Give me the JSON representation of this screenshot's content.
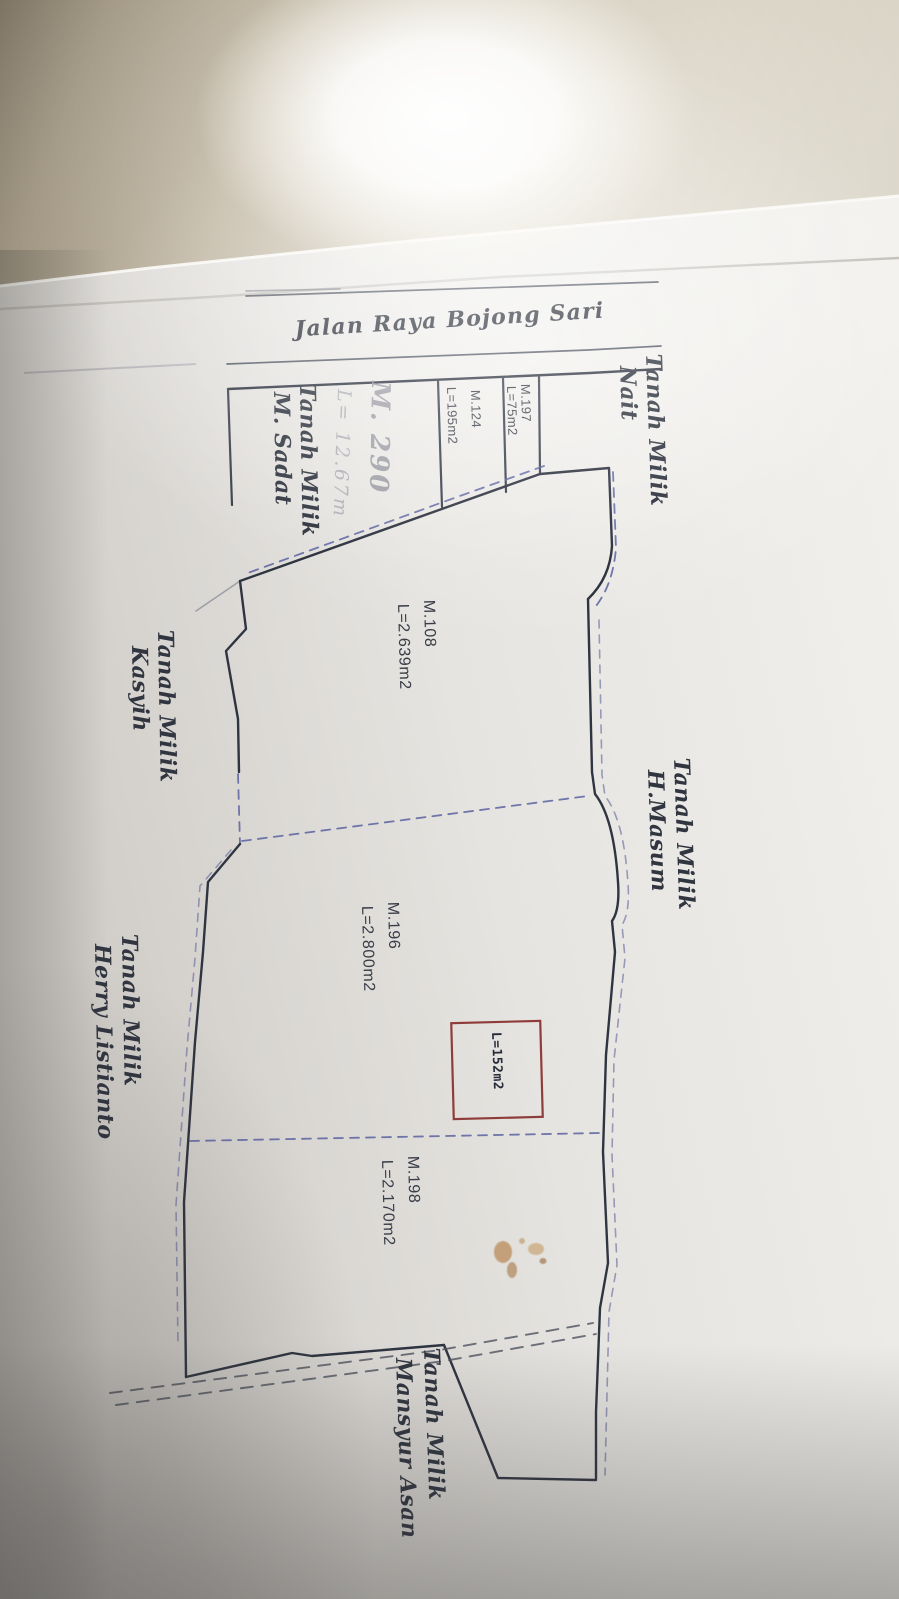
{
  "photo": {
    "description": "Photographed paper land-plot sketch map on a beige wall with camera flash glare",
    "road": {
      "name": "Jalan Raya Bojong Sari"
    },
    "plots": {
      "m197": {
        "id": "M.197",
        "area": "L=75m2"
      },
      "m124": {
        "id": "M.124",
        "area": "L=195m2"
      },
      "m108": {
        "id": "M.108",
        "area": "L=2.639m2"
      },
      "m196": {
        "id": "M.196",
        "area": "L=2.800m2"
      },
      "m198": {
        "id": "M.198",
        "area": "L=2.170m2"
      },
      "red_box": {
        "area": "L=152m2"
      },
      "handwritten": {
        "id": "M. 290",
        "area": "L= 12.67m"
      }
    },
    "owners": {
      "nait": {
        "line1": "Tanah Milik",
        "line2": "Nait"
      },
      "sadat": {
        "line1": "Tanah Milik",
        "line2": "M. Sadat"
      },
      "masum": {
        "line1": "Tanah Milik",
        "line2": "H.Masum"
      },
      "kasyih": {
        "line1": "Tanah Milik",
        "line2": "Kasyih"
      },
      "herry": {
        "line1": "Tanah Milik",
        "line2": "Herry Listianto"
      },
      "mansyur": {
        "line1": "Tanah Milik",
        "line2": "Mansyur Asan"
      }
    },
    "colors": {
      "ink": "#3a3f4c",
      "boundary_dash_blue": "#5a61a0",
      "path_dash_gray": "#4c515c",
      "red_box_border": "#8f3d3a",
      "pencil": "#94949e",
      "wall_beige": "#b3a78f",
      "paper": "#e9e7e3",
      "stain": "#b5854e"
    }
  }
}
